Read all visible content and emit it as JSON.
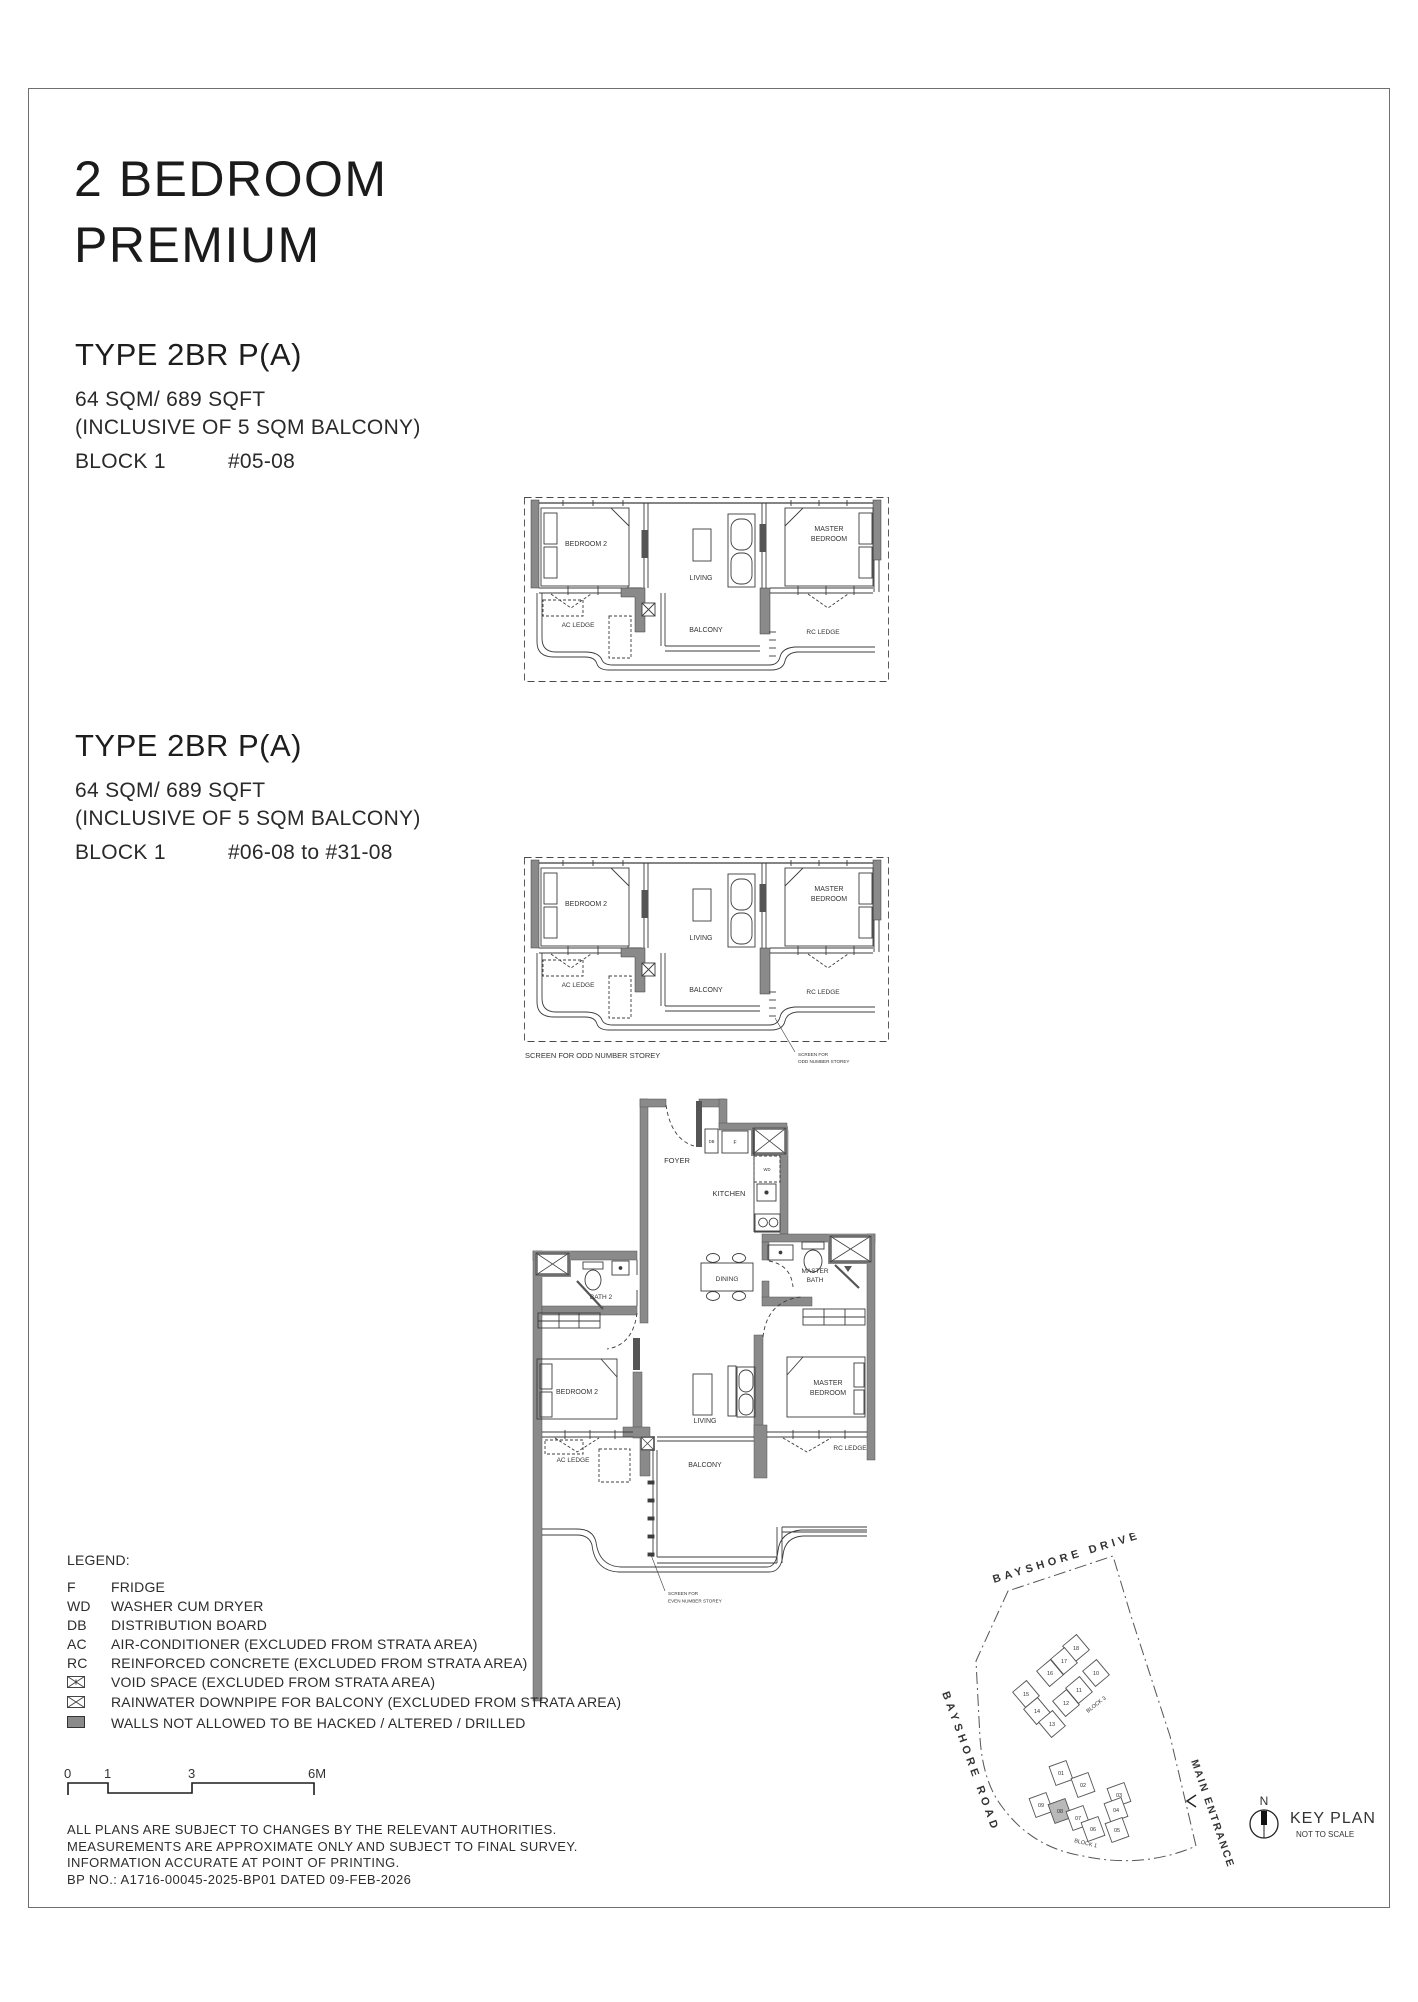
{
  "header": {
    "title_line1": "2 BEDROOM",
    "title_line2": "PREMIUM"
  },
  "sections": [
    {
      "type_label": "TYPE 2BR P(A)",
      "area": "64 SQM/ 689 SQFT",
      "inclusive": "(INCLUSIVE OF 5 SQM BALCONY)",
      "block": "BLOCK 1",
      "units": "#05-08"
    },
    {
      "type_label": "TYPE 2BR P(A)",
      "area": "64 SQM/ 689 SQFT",
      "inclusive": "(INCLUSIVE OF 5 SQM BALCONY)",
      "block": "BLOCK 1",
      "units": "#06-08 to #31-08"
    }
  ],
  "plan_labels": {
    "bedroom2": "BEDROOM 2",
    "living": "LIVING",
    "master_l1": "MASTER",
    "master_l2": "BEDROOM",
    "ac_ledge": "AC LEDGE",
    "balcony": "BALCONY",
    "rc_ledge": "RC LEDGE",
    "foyer": "FOYER",
    "kitchen": "KITCHEN",
    "dining": "DINING",
    "master_bath_l1": "MASTER",
    "master_bath_l2": "BATH",
    "bath2": "BATH 2",
    "db": "DB",
    "f": "F",
    "wd": "WD"
  },
  "screen_notes": {
    "odd_full": "SCREEN FOR ODD NUMBER STOREY",
    "callout_line1": "SCREEN FOR",
    "odd_line2": "ODD NUMBER STOREY",
    "even_line2": "EVEN NUMBER STOREY"
  },
  "legend": {
    "heading": "LEGEND:",
    "items": [
      {
        "key": "F",
        "desc": "FRIDGE"
      },
      {
        "key": "WD",
        "desc": "WASHER CUM DRYER"
      },
      {
        "key": "DB",
        "desc": "DISTRIBUTION BOARD"
      },
      {
        "key": "AC",
        "desc": "AIR-CONDITIONER (EXCLUDED FROM STRATA AREA)"
      },
      {
        "key": "RC",
        "desc": "REINFORCED CONCRETE (EXCLUDED FROM STRATA AREA)"
      },
      {
        "key": "",
        "desc": "VOID SPACE (EXCLUDED FROM STRATA AREA)"
      },
      {
        "key": "",
        "desc": "RAINWATER DOWNPIPE FOR BALCONY (EXCLUDED FROM STRATA AREA)"
      },
      {
        "key": "",
        "desc": "WALLS NOT ALLOWED TO BE HACKED / ALTERED / DRILLED"
      }
    ]
  },
  "scale_bar": {
    "t0": "0",
    "t1": "1",
    "t3": "3",
    "t6": "6M"
  },
  "disclaimer": {
    "line1": "ALL PLANS ARE SUBJECT TO CHANGES BY THE RELEVANT AUTHORITIES.",
    "line2": "MEASUREMENTS ARE APPROXIMATE ONLY AND SUBJECT TO FINAL SURVEY.",
    "line3": "INFORMATION ACCURATE AT POINT OF PRINTING.",
    "line4": "BP NO.: A1716-00045-2025-BP01 DATED 09-FEB-2026"
  },
  "key_plan": {
    "road_top": "BAYSHORE DRIVE",
    "road_left": "BAYSHORE ROAD",
    "entrance": "MAIN ENTRANCE",
    "block3_label": "BLOCK 3",
    "block1_label": "BLOCK 1",
    "block3_units": [
      "18",
      "17",
      "16",
      "10",
      "15",
      "11",
      "12",
      "14",
      "13"
    ],
    "block1_units": [
      "01",
      "02",
      "03",
      "09",
      "08",
      "07",
      "04",
      "06",
      "05"
    ],
    "highlighted_unit": "08",
    "compass": "N",
    "title": "KEY PLAN",
    "subtitle": "NOT TO SCALE"
  },
  "colors": {
    "wall": "#8a8a8a",
    "line": "#3c3c3c",
    "highlight": "#b9b9b9"
  }
}
